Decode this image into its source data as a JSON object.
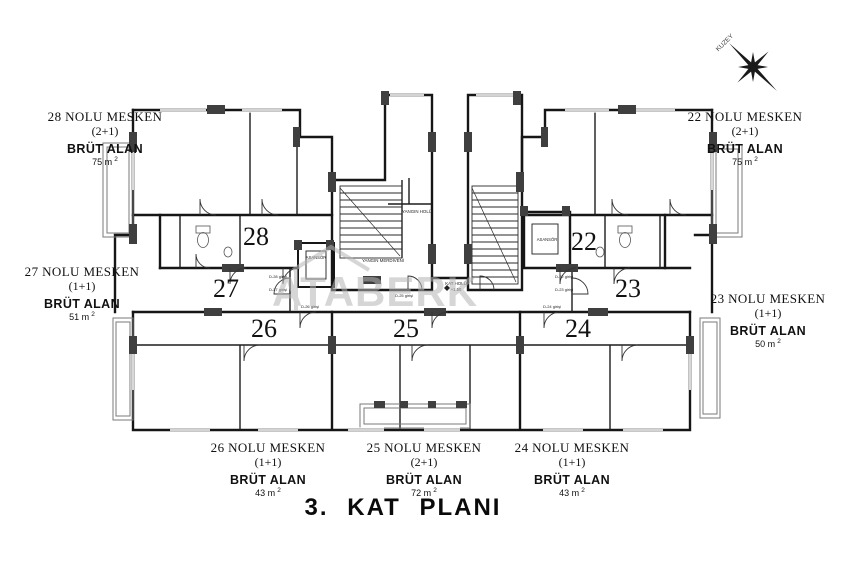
{
  "page": {
    "title": "3. KAT PLANI",
    "background": "#ffffff",
    "ink": "#161616"
  },
  "compass": {
    "label": "KUZEY"
  },
  "watermark": {
    "text": "ATABERK",
    "color": "#b5b5b5"
  },
  "core_labels": {
    "yangin_holu": "YANGIN HOLÜ",
    "yangin_merdiveni": "YANGIN MERDİVENİ",
    "asansor_left": "ASANSÖR",
    "asansor_right": "ASANSÖR",
    "kat_holu": "KAT HOLÜ",
    "kat_holu_level": "+1.50"
  },
  "units": [
    {
      "number": "28",
      "name": "28 NOLU MESKEN",
      "type": "(2+1)",
      "area_title": "BRÜT ALAN",
      "area_value": "75 m",
      "area_sup": "2",
      "entry": "D-28 girişi"
    },
    {
      "number": "27",
      "name": "27 NOLU MESKEN",
      "type": "(1+1)",
      "area_title": "BRÜT ALAN",
      "area_value": "51 m",
      "area_sup": "2",
      "entry": "D-27 girişi"
    },
    {
      "number": "26",
      "name": "26 NOLU MESKEN",
      "type": "(1+1)",
      "area_title": "BRÜT ALAN",
      "area_value": "43 m",
      "area_sup": "2",
      "entry": "D-26 girişi"
    },
    {
      "number": "25",
      "name": "25 NOLU MESKEN",
      "type": "(2+1)",
      "area_title": "BRÜT ALAN",
      "area_value": "72 m",
      "area_sup": "2",
      "entry": "D-25 girişi"
    },
    {
      "number": "24",
      "name": "24 NOLU MESKEN",
      "type": "(1+1)",
      "area_title": "BRÜT ALAN",
      "area_value": "43 m",
      "area_sup": "2",
      "entry": "D-24 girişi"
    },
    {
      "number": "23",
      "name": "23 NOLU MESKEN",
      "type": "(1+1)",
      "area_title": "BRÜT ALAN",
      "area_value": "50 m",
      "area_sup": "2",
      "entry": "D-23 girişi"
    },
    {
      "number": "22",
      "name": "22 NOLU MESKEN",
      "type": "(2+1)",
      "area_title": "BRÜT ALAN",
      "area_value": "75 m",
      "area_sup": "2",
      "entry": "D-22 girişi"
    }
  ]
}
